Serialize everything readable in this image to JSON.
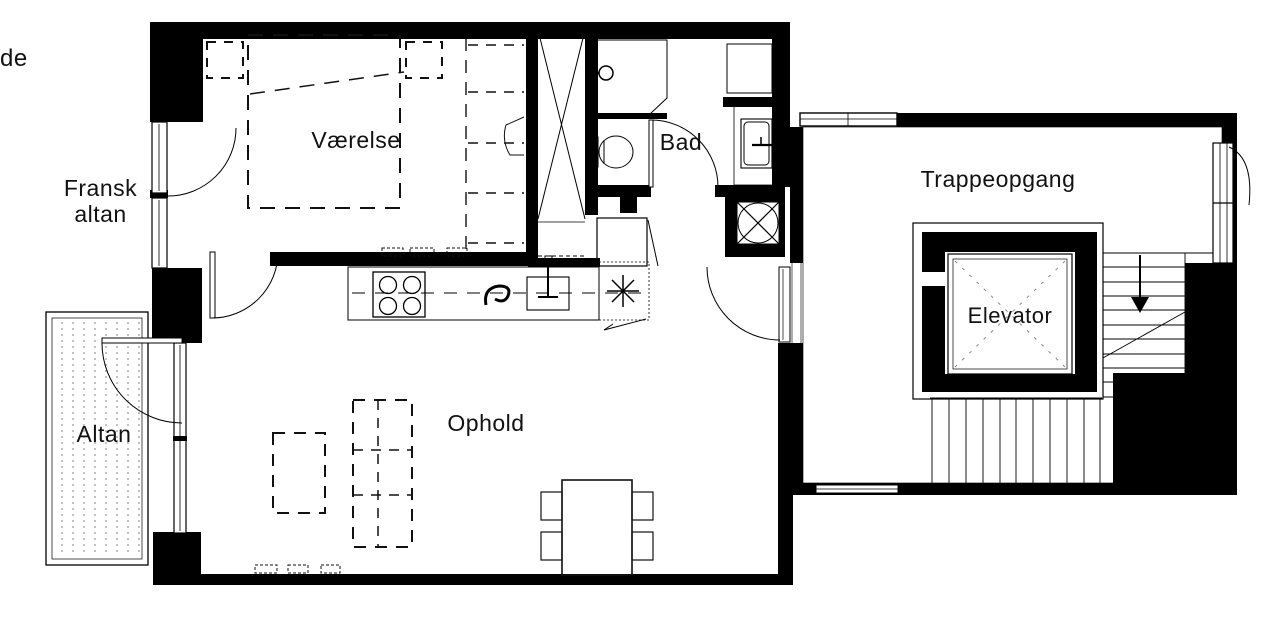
{
  "document_type": "apartment floor plan",
  "language": "Danish",
  "labels": {
    "fragment": "de",
    "fransk": "Fransk",
    "fransk2": "altan",
    "vaerelse": "Værelse",
    "bad": "Bad",
    "ophold": "Ophold",
    "altan": "Altan",
    "trappeopgang": "Trappeopgang",
    "elevator": "Elevator"
  },
  "rooms": [
    {
      "id": "vaerelse",
      "name": "Værelse",
      "contents": [
        "bed (dashed)",
        "two nightstands (dashed)",
        "wardrobe with door",
        "french balcony door"
      ]
    },
    {
      "id": "bad",
      "name": "Bad",
      "contents": [
        "washbasin",
        "toilet",
        "shower area",
        "washing machine niche",
        "door"
      ]
    },
    {
      "id": "ophold",
      "name": "Ophold",
      "contents": [
        "sofa (dashed)",
        "coffee table (dashed)",
        "dining table with 4 chairs",
        "kitchen counter with stove and sink",
        "balcony door",
        "entry door"
      ]
    },
    {
      "id": "altan",
      "name": "Altan",
      "contents": [
        "decking lines"
      ]
    },
    {
      "id": "fransk-altan",
      "name": "Fransk altan",
      "contents": []
    },
    {
      "id": "trappeopgang",
      "name": "Trappeopgang",
      "contents": [
        "elevator shaft",
        "stairs with down arrow",
        "windows"
      ]
    }
  ],
  "symbols": {
    "stove": "square with 4 burner circles",
    "sink": "rectangle with faucet tee",
    "drain_swirl": "spiral squiggle on counter",
    "ceiling_lamp": "eight-point asterisk",
    "duct_shaft": "black square with inscribed circle and X",
    "elevator_car": "square with dashed X diagonals",
    "stairs_down_arrow": "arrow pointing down",
    "radiator_marks": "short dashed rectangles along walls"
  },
  "colors": {
    "background": "#ffffff",
    "wall": "#000000",
    "thin_line": "#1a1a1a",
    "light_dash": "#888888",
    "deck_line": "#666666"
  }
}
